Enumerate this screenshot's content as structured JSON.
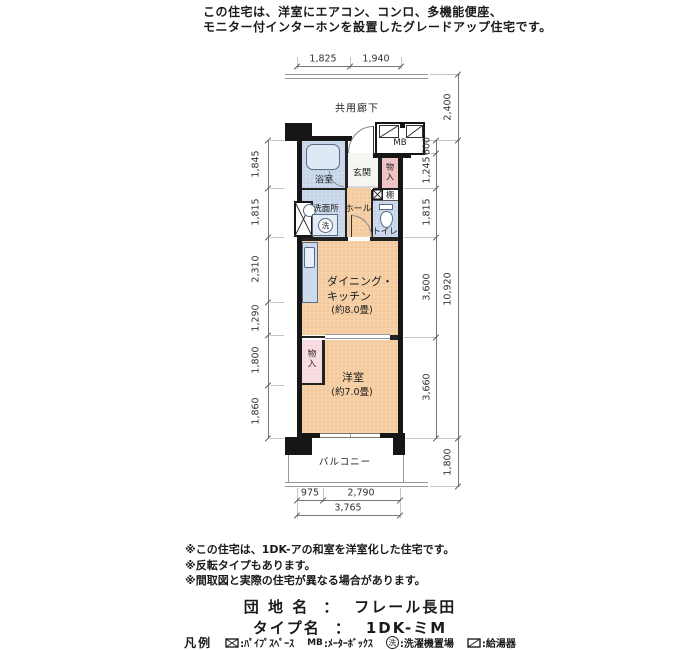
{
  "header": {
    "line1": "この住宅は、洋室にエアコン、コンロ、多機能便座、",
    "line2": "モニター付インターホンを設置したグレードアップ住宅です。"
  },
  "plan": {
    "corridor": "共用廊下",
    "balcony": "バルコニー",
    "mb": "MB",
    "rooms": {
      "bath": "浴室",
      "entrance": "玄関",
      "closet1": [
        "物",
        "入"
      ],
      "shelf": "棚",
      "washroom": "洗面所",
      "washer_symbol": "洗",
      "hall": "ホール",
      "toilet": "トイレ",
      "dk1": "ダイニング・",
      "dk2": "キッチン",
      "dk_size": "(約8.0畳)",
      "closet2": [
        "物",
        "入"
      ],
      "western": "洋室",
      "western_size": "(約7.0畳)"
    },
    "dims": {
      "top": [
        "1,825",
        "1,940"
      ],
      "left": [
        "1,845",
        "1,815",
        "2,310",
        "1,290",
        "1,800",
        "1,860"
      ],
      "right_inner": [
        "600",
        "1,245",
        "1,815",
        "3,600",
        "3,660"
      ],
      "right_outer": [
        "2,400",
        "10,920",
        "1,800"
      ],
      "bottom": [
        "975",
        "2,790"
      ],
      "bottom_total": "3,765"
    }
  },
  "notes": [
    "※この住宅は、1DK-アの和室を洋室化した住宅です。",
    "※反転タイプもあります。",
    "※間取図と実際の住宅が異なる場合があります。"
  ],
  "info": {
    "estate_label": "団 地 名",
    "estate_sep": "：",
    "estate_value": "フレール長田",
    "type_label": "タイプ名",
    "type_sep": "：",
    "type_value": "1DK-ミM"
  },
  "legend": {
    "title": "凡例",
    "items": [
      {
        "symbol": "pipe-space",
        "label": ":ﾊﾟｲﾌﾟｽﾍﾟｰｽ"
      },
      {
        "symbol": "meter-box",
        "symbol_text": "MB",
        "label": ":ﾒｰﾀｰﾎﾞｯｸｽ"
      },
      {
        "symbol": "washer-place",
        "symbol_text": "洗",
        "label": ":洗濯機置場"
      },
      {
        "symbol": "water-heater",
        "label": ":給湯器"
      }
    ]
  },
  "colors": {
    "wall": "#161616",
    "room_warm": "#f6d0a6",
    "room_cool": "#ccdaec",
    "room_pink": "#f2c6c6",
    "room_pink_light": "#f8dde2",
    "fixture_stroke": "#5a6b85"
  }
}
